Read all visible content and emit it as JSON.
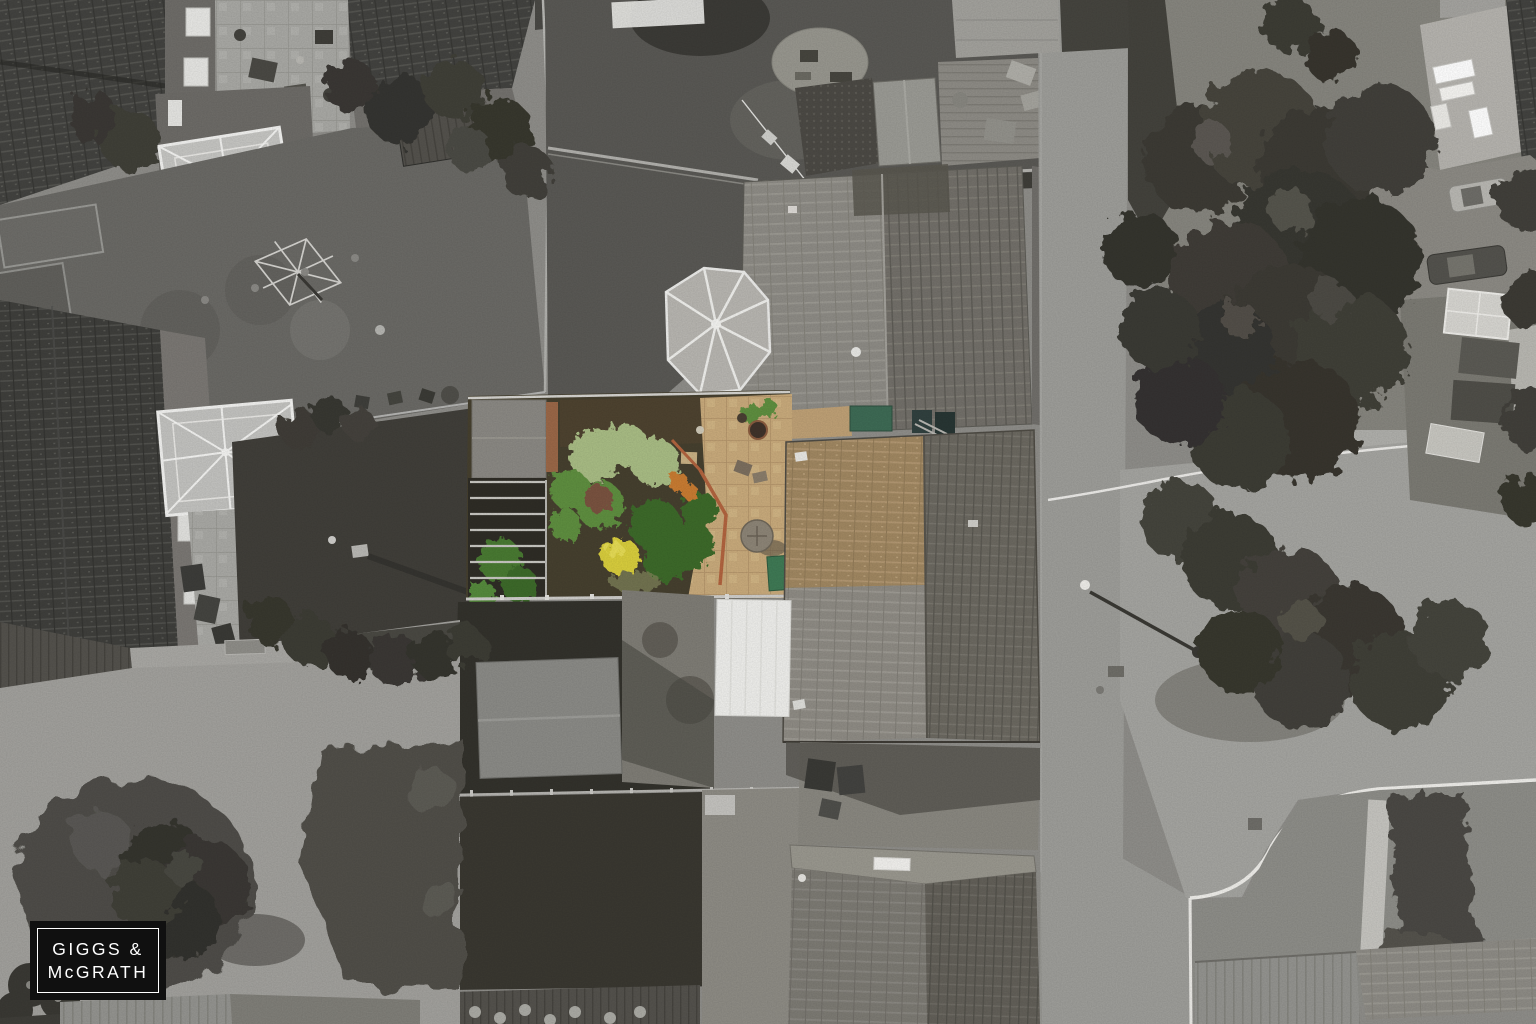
{
  "watermark": {
    "line1": "GIGGS &",
    "line2": "McGRATH",
    "box_color": "#101010",
    "text_color": "#ffffff"
  },
  "palette": {
    "featured_garden_green_light": "#a9bd85",
    "featured_garden_green_mid": "#5f8f3f",
    "featured_garden_green_dark": "#3e6b2c",
    "featured_garden_yellow": "#d9ce3c",
    "featured_garden_orange": "#c97c33",
    "featured_foliage_red": "#7a5240",
    "featured_patio_tan": "#c9ab7c",
    "featured_path_terracotta": "#b2643f",
    "featured_roof_tan": "#a18862",
    "featured_storage_green": "#3f7a55",
    "featured_hot_tub_green": "#3e6b55",
    "mono_road": "#9e9e9a",
    "mono_paving_light": "#a2a19d",
    "mono_lawn": "#5c5b55",
    "mono_tree_dark": "#3a3934",
    "mono_roof_dark": "#434340",
    "mono_roof_mid": "#8e8c86",
    "mono_white_conservatory": "#efefec"
  }
}
